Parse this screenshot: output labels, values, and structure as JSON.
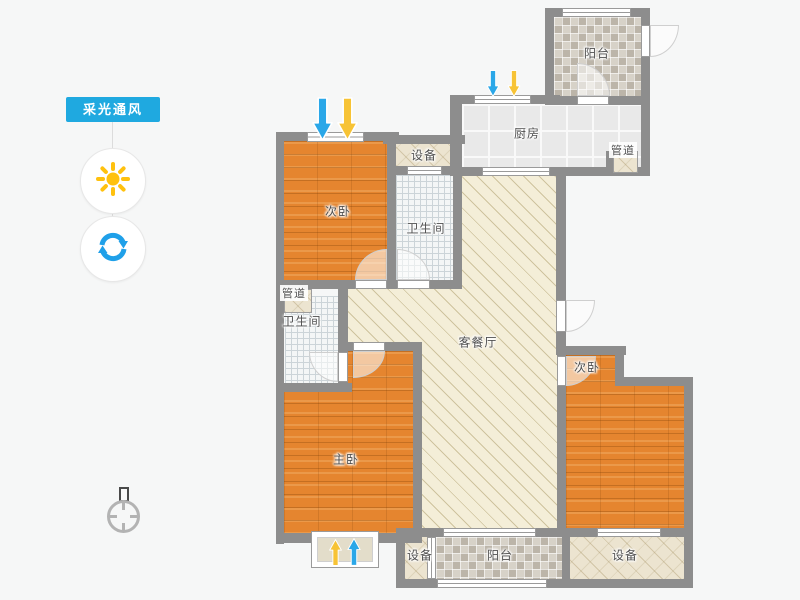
{
  "app": {
    "background": "#f6f7f7"
  },
  "sidebar": {
    "panel_label": "采光通风",
    "icons": [
      {
        "name": "sun-icon",
        "color": "#ffc10e"
      },
      {
        "name": "refresh-icon",
        "color": "#1fa0e9"
      },
      {
        "name": "compass-icon",
        "color": "#b3b3b3"
      }
    ]
  },
  "plan": {
    "rooms": [
      {
        "id": "balcony-top",
        "label": "阳台"
      },
      {
        "id": "kitchen",
        "label": "厨房"
      },
      {
        "id": "duct-kitchen",
        "label": "管道"
      },
      {
        "id": "equipment-top",
        "label": "设备"
      },
      {
        "id": "bedroom-top-left",
        "label": "次卧"
      },
      {
        "id": "bathroom-top",
        "label": "卫生间"
      },
      {
        "id": "duct-left",
        "label": "管道"
      },
      {
        "id": "bathroom-left",
        "label": "卫生间"
      },
      {
        "id": "living-dining",
        "label": "客餐厅"
      },
      {
        "id": "master-bedroom",
        "label": "主卧"
      },
      {
        "id": "bedroom-right",
        "label": "次卧"
      },
      {
        "id": "equipment-bottom-left",
        "label": "设备"
      },
      {
        "id": "balcony-bottom",
        "label": "阳台"
      },
      {
        "id": "equipment-bottom-right",
        "label": "设备"
      }
    ],
    "wind_arrows": [
      {
        "location": "bedroom-top-left-window",
        "direction": "down",
        "color": "#2aa7e8"
      },
      {
        "location": "bedroom-top-left-window",
        "direction": "down",
        "color": "#f7c335"
      },
      {
        "location": "kitchen-window",
        "direction": "down",
        "color": "#2aa7e8"
      },
      {
        "location": "kitchen-window",
        "direction": "down",
        "color": "#f7c335"
      },
      {
        "location": "master-bay-window",
        "direction": "up",
        "color": "#f7c335"
      },
      {
        "location": "master-bay-window",
        "direction": "up",
        "color": "#2aa7e8"
      }
    ],
    "colors": {
      "wall": "#8d8d8d",
      "wood_floor": "#e5852f",
      "living_floor": "#f4eed8",
      "balcony_tile": "#d7d2c8",
      "bath_tile": "#f4f6f6",
      "kitchen_tile": "#e9e9e9",
      "arrow_blue": "#2aa7e8",
      "arrow_yellow": "#f7c335",
      "panel_blue": "#1fa9e0"
    }
  }
}
